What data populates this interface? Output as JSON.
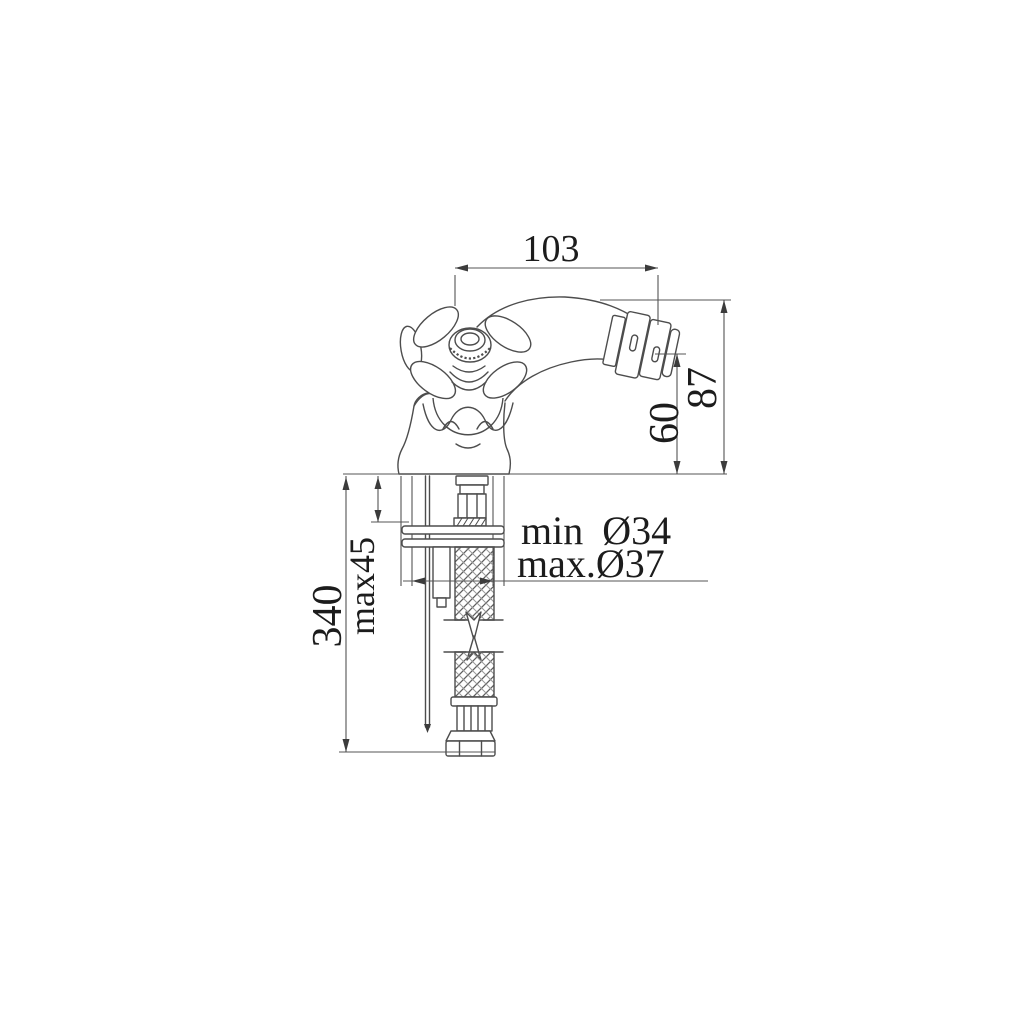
{
  "colors": {
    "background": "#ffffff",
    "line": "#4d4d4d",
    "dimension_line": "#545454",
    "text": "#1c1c1c"
  },
  "labels": {
    "dim_103": "103",
    "dim_87": "87",
    "dim_60": "60",
    "dim_340": "340",
    "dim_max45": "max45",
    "hole_min": "min Ø34",
    "hole_max": "max.Ø37"
  }
}
